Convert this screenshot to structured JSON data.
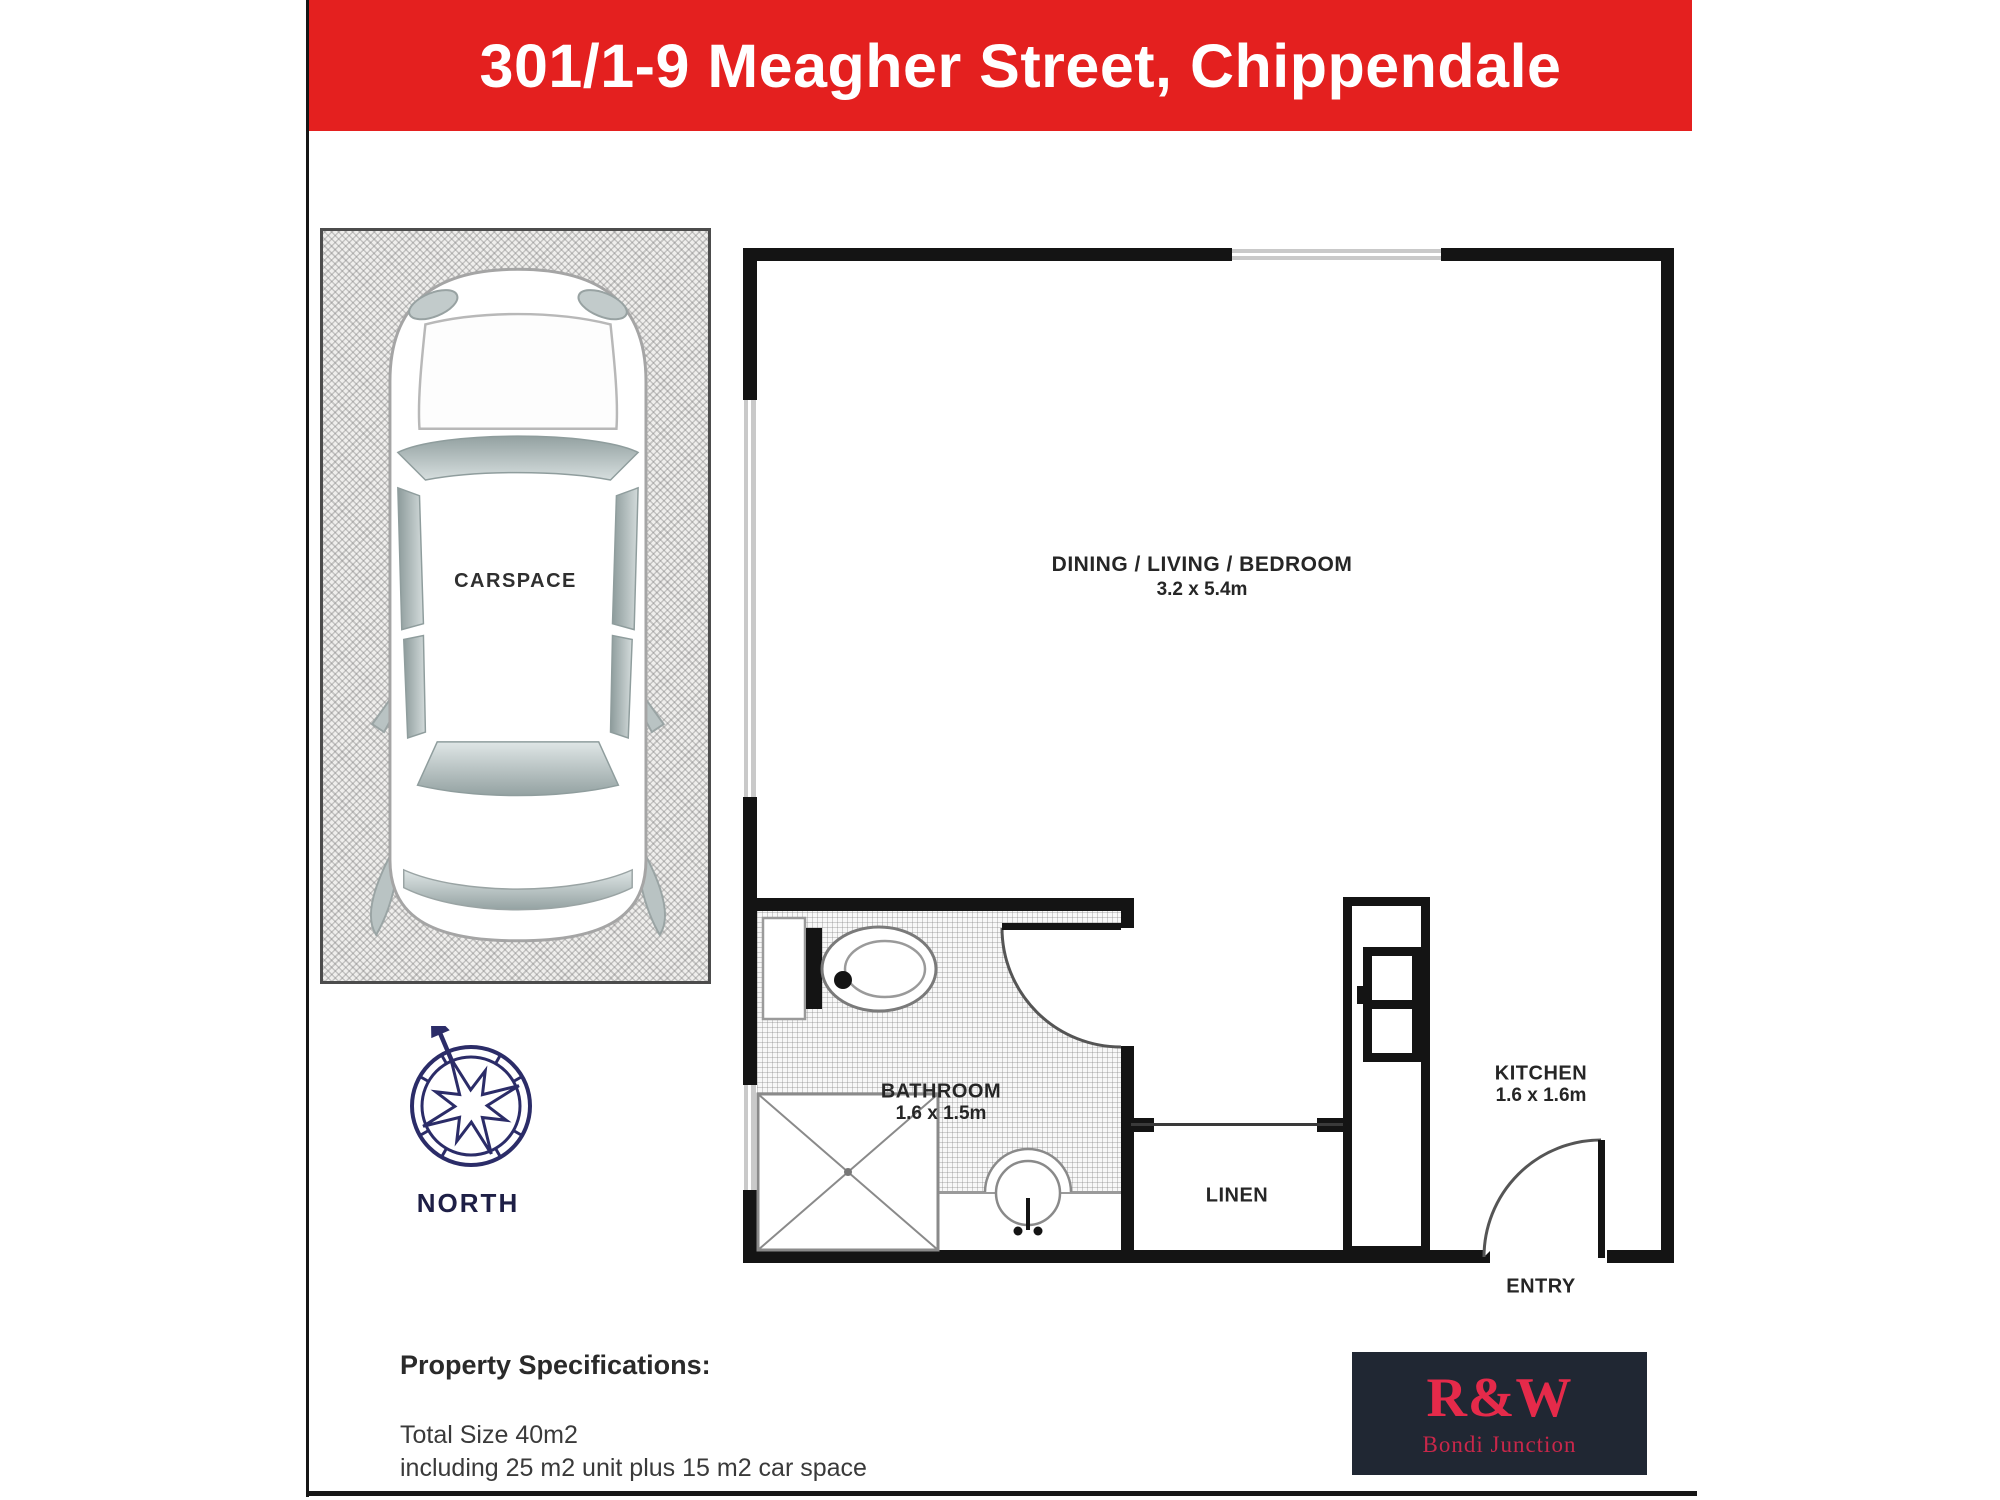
{
  "banner": {
    "title": "301/1-9 Meagher Street, Chippendale"
  },
  "carspace": {
    "label": "CARSPACE"
  },
  "compass": {
    "label": "NORTH"
  },
  "rooms": {
    "living": {
      "name": "DINING / LIVING / BEDROOM",
      "dims": "3.2 x 5.4m"
    },
    "bathroom": {
      "name": "BATHROOM",
      "dims": "1.6 x 1.5m"
    },
    "linen": {
      "name": "LINEN"
    },
    "kitchen": {
      "name": "KITCHEN",
      "dims": "1.6 x 1.6m"
    },
    "entry": {
      "name": "ENTRY"
    }
  },
  "specs": {
    "heading": "Property Specifications:",
    "line1": "Total Size 40m2",
    "line2": "including 25 m2 unit plus 15 m2 car space"
  },
  "logo": {
    "brand": "R&W",
    "office": "Bondi Junction"
  },
  "colors": {
    "banner_red": "#e4201f",
    "wall_black": "#141414",
    "window_gray": "#c9c9c9",
    "compass_navy": "#2b2c68",
    "logo_bg": "#202733",
    "logo_red": "#e52a4a"
  }
}
